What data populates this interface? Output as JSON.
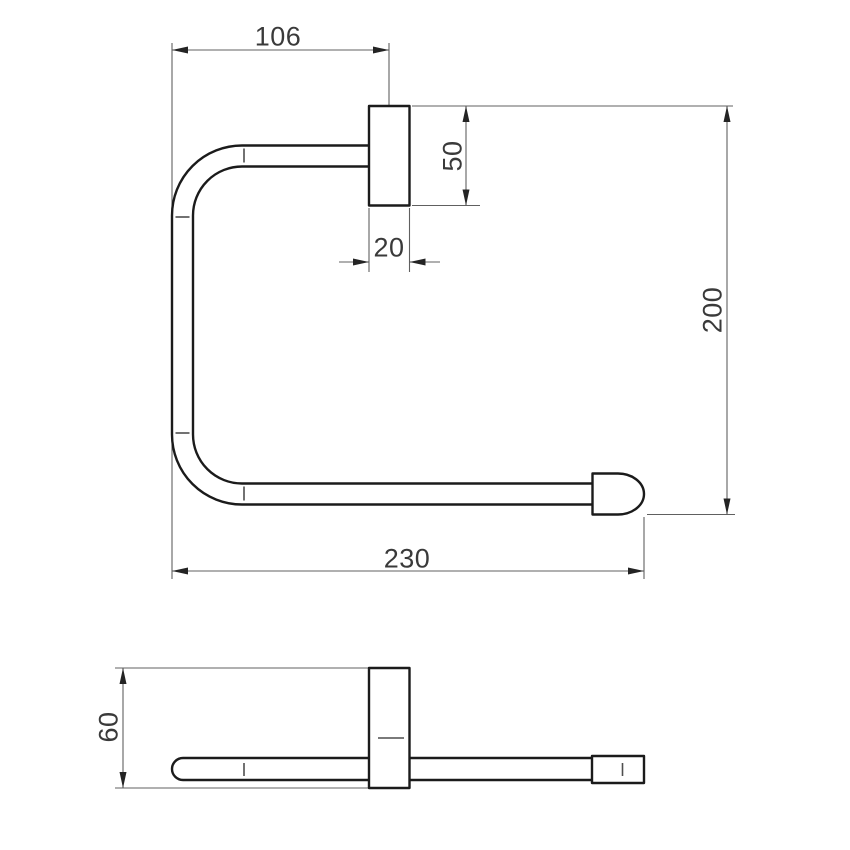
{
  "drawing": {
    "colors": {
      "background": "#ffffff",
      "object_line": "#1b1b1b",
      "dimension_line": "#606060",
      "label_text": "#3a3a3a"
    },
    "front_view": {
      "dim_left_to_plate_center": "106",
      "dim_plate_height": "50",
      "dim_plate_width": "20",
      "dim_overall_height": "200",
      "dim_overall_width": "230"
    },
    "side_view": {
      "dim_overall_depth": "60"
    }
  }
}
